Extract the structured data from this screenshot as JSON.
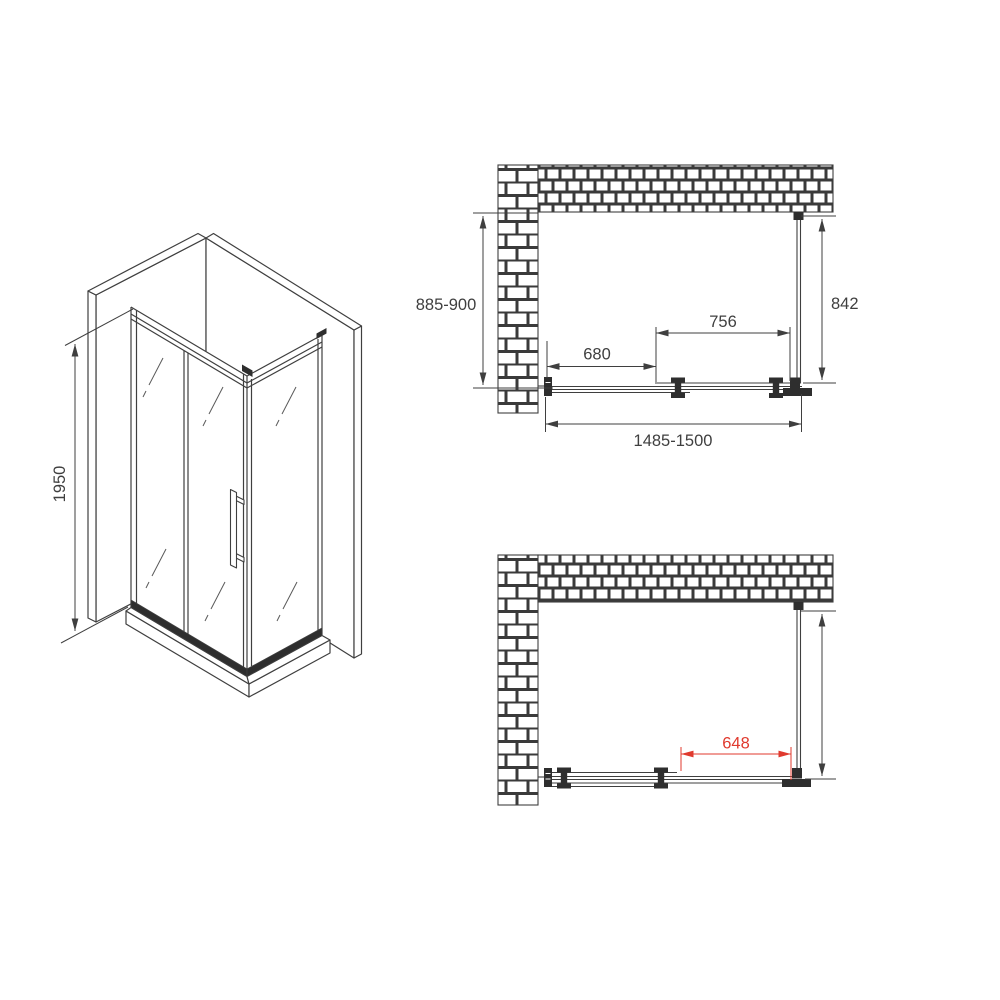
{
  "drawing": {
    "background": "#ffffff",
    "line_color": "#3f3f3f",
    "dark_fill": "#2e2e2e",
    "accent_red": "#e03a2e",
    "views": {
      "isometric": {
        "height": "1950"
      },
      "plan_closed": {
        "depth": "885-900",
        "side_panel_depth": "842",
        "fixed_panel_width": "756",
        "door_width": "680",
        "total_width": "1485-1500"
      },
      "plan_open": {
        "opening_width": "648"
      }
    }
  }
}
